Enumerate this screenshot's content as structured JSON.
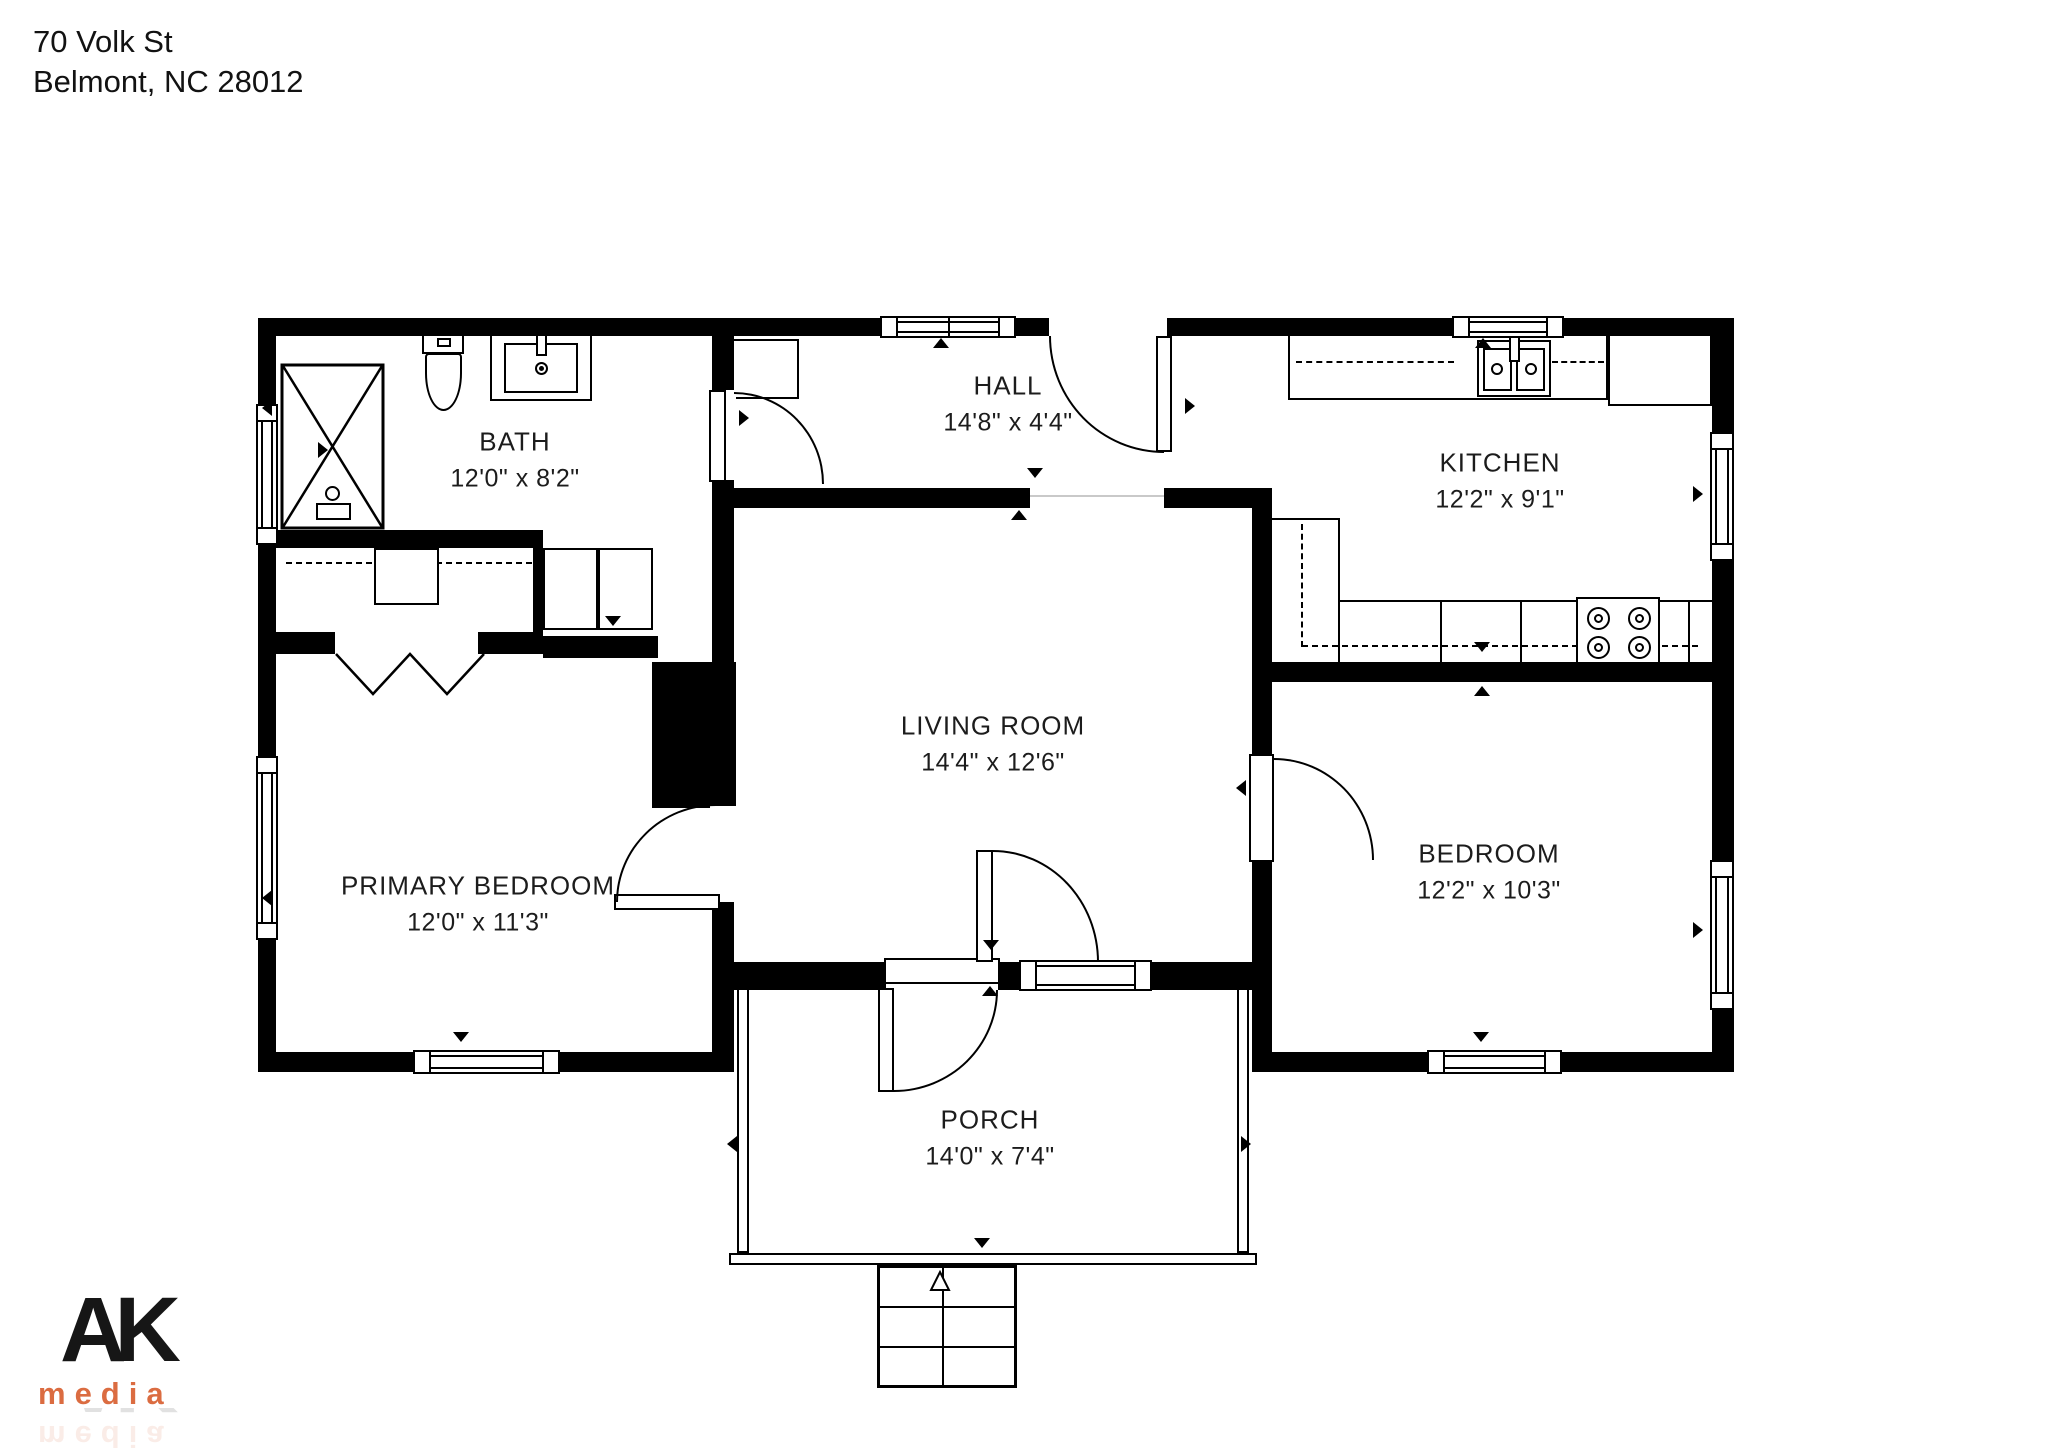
{
  "address": {
    "line1": "70 Volk St",
    "line2": "Belmont, NC  28012"
  },
  "rooms": [
    {
      "id": "bath",
      "name": "BATH",
      "dims": "12'0\" x 8'2\""
    },
    {
      "id": "hall",
      "name": "HALL",
      "dims": "14'8\" x 4'4\""
    },
    {
      "id": "kitchen",
      "name": "KITCHEN",
      "dims": "12'2\" x 9'1\""
    },
    {
      "id": "living",
      "name": "LIVING ROOM",
      "dims": "14'4\" x 12'6\""
    },
    {
      "id": "primary",
      "name": "PRIMARY BEDROOM",
      "dims": "12'0\" x 11'3\""
    },
    {
      "id": "bedroom",
      "name": "BEDROOM",
      "dims": "12'2\" x 10'3\""
    },
    {
      "id": "porch",
      "name": "PORCH",
      "dims": "14'0\" x 7'4\""
    }
  ],
  "logo": {
    "top": "AK",
    "bottom": "media",
    "accent_color": "#db6c41",
    "text_color": "#161616"
  },
  "colors": {
    "background": "#ffffff",
    "wall": "#000000",
    "line": "#1c1c1c"
  }
}
